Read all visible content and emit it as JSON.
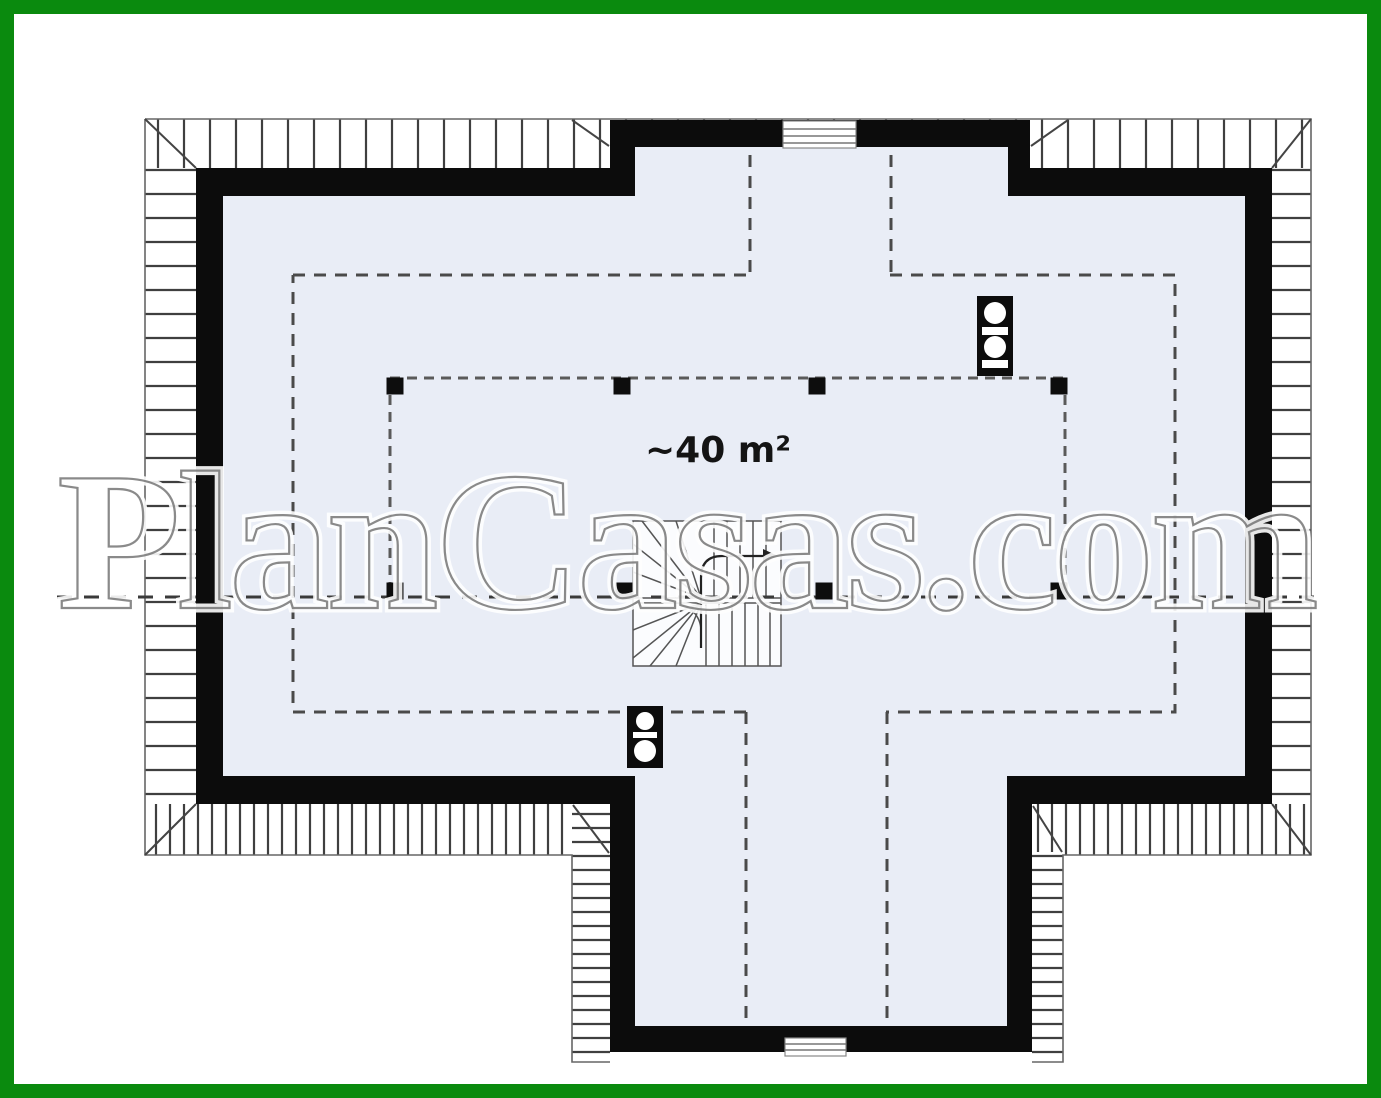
{
  "floor_plan": {
    "area_label": "~40 m²",
    "watermark": "PlanCasas.com",
    "colors": {
      "frame_green": "#0a8a0e",
      "wall_black": "#0c0c0c",
      "floor_fill": "#e9edf6",
      "dash_gray": "#4a4a4a",
      "hatch_tick": "#3f3f3f",
      "roof_edge": "#666666",
      "watermark_gray": "#6e6e6e"
    }
  }
}
